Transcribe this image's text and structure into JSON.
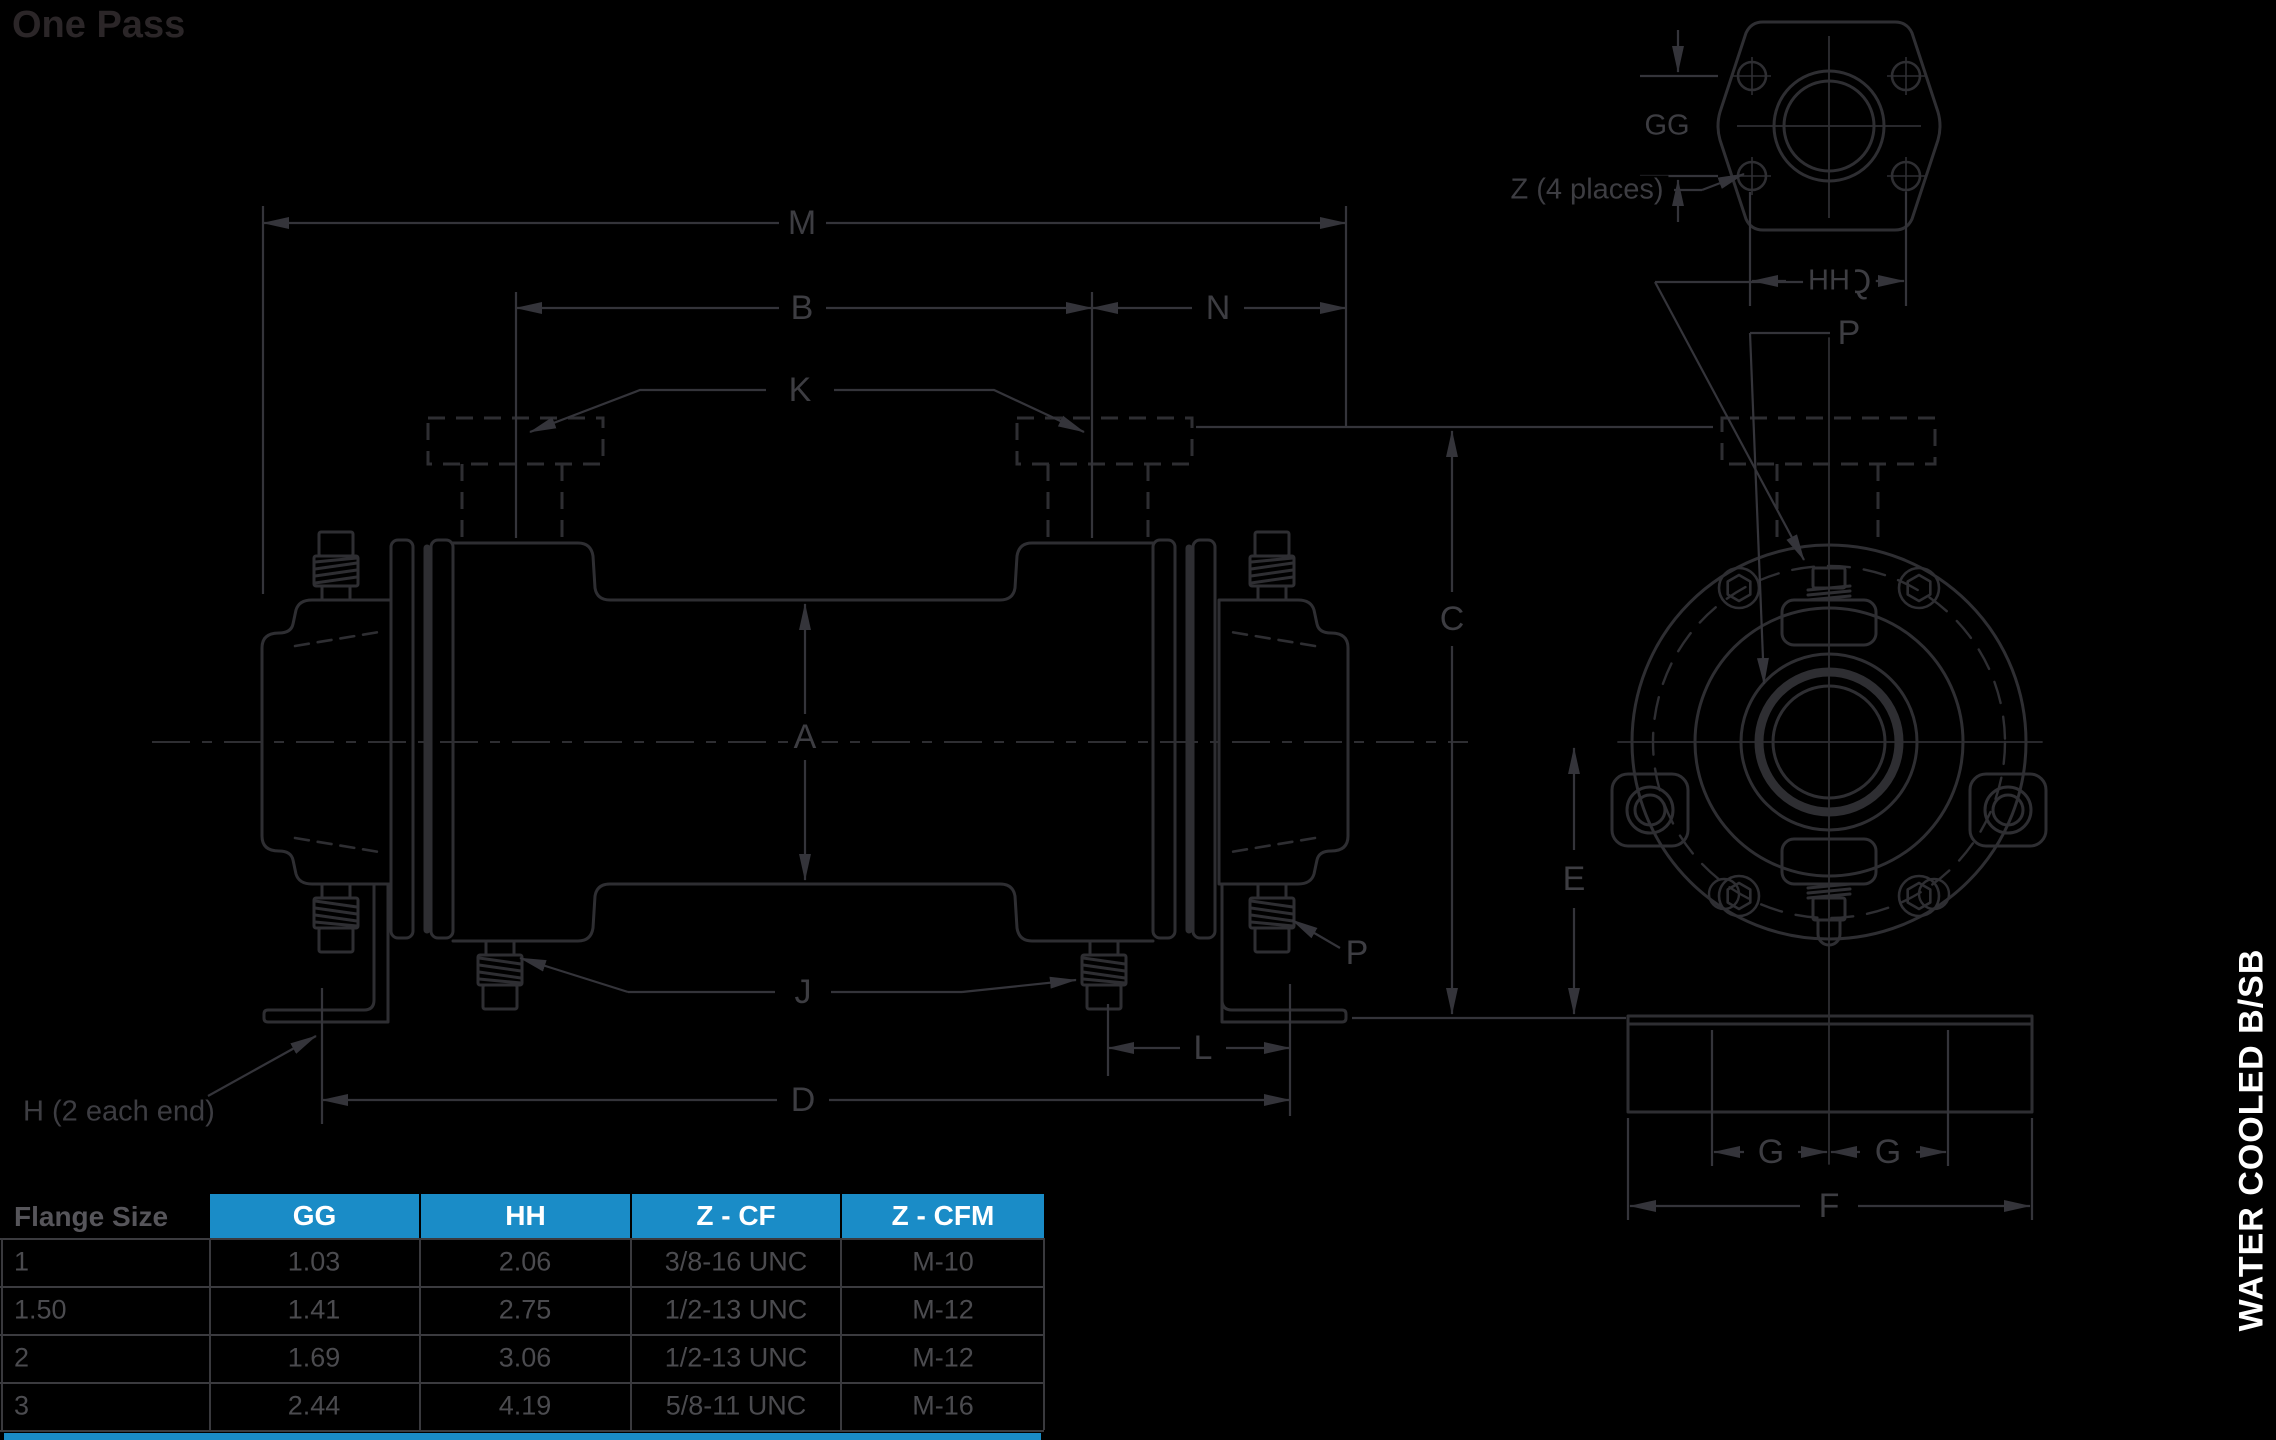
{
  "title": "One Pass",
  "side_label": "WATER COOLED  B/SB",
  "colors": {
    "accent_blue": "#1A8CC7",
    "line_art": "#2e2e32",
    "dim_label": "#3d3d42",
    "table_text": "#4b4b4f",
    "title_text": "#2b2628",
    "header_text": "#ffffff"
  },
  "diagram": {
    "labels": {
      "m": "M",
      "b": "B",
      "n": "N",
      "k": "K",
      "a": "A",
      "c": "C",
      "e": "E",
      "j": "J",
      "l": "L",
      "d": "D",
      "f": "F",
      "g_left": "G",
      "g_right": "G",
      "gg": "GG",
      "hh": "HH",
      "q": "Q",
      "p_top": "P",
      "p_side": "P",
      "z_note": "Z (4 places)",
      "h_note": "H (2 each end)"
    }
  },
  "table": {
    "row_header": "Flange Size",
    "columns": [
      "GG",
      "HH",
      "Z - CF",
      "Z - CFM"
    ],
    "rows": [
      {
        "flange": "1",
        "gg": "1.03",
        "hh": "2.06",
        "z_cf": "3/8-16 UNC",
        "z_cfm": "M-10"
      },
      {
        "flange": "1.50",
        "gg": "1.41",
        "hh": "2.75",
        "z_cf": "1/2-13 UNC",
        "z_cfm": "M-12"
      },
      {
        "flange": "2",
        "gg": "1.69",
        "hh": "3.06",
        "z_cf": "1/2-13 UNC",
        "z_cfm": "M-12"
      },
      {
        "flange": "3",
        "gg": "2.44",
        "hh": "4.19",
        "z_cf": "5/8-11 UNC",
        "z_cfm": "M-16"
      }
    ]
  }
}
